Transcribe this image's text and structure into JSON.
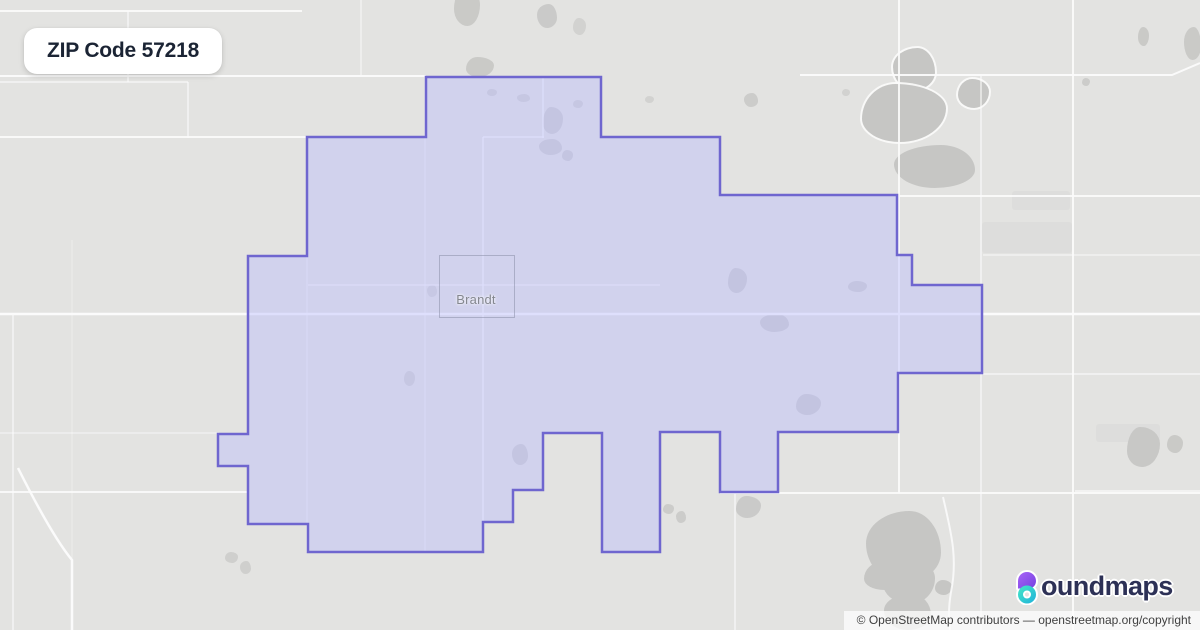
{
  "badge": {
    "label": "ZIP Code 57218"
  },
  "map": {
    "place_label": "Brandt",
    "place_box": {
      "x": 439,
      "y": 255,
      "w": 74,
      "h": 61
    },
    "colors": {
      "background": "#e3e3e1",
      "road": "#fbfbfb",
      "blob": "#c6c6c4",
      "patch": "#dbdbd9",
      "zip_fill": "rgba(186,188,252,0.45)",
      "zip_stroke": "#6f66cf",
      "place_label_color": "#84878f",
      "badge_text_color": "#1b2434"
    },
    "zip_polygon": [
      [
        426,
        77
      ],
      [
        601,
        77
      ],
      [
        601,
        137
      ],
      [
        720,
        137
      ],
      [
        720,
        195
      ],
      [
        897,
        195
      ],
      [
        897,
        255
      ],
      [
        912,
        255
      ],
      [
        912,
        285
      ],
      [
        982,
        285
      ],
      [
        982,
        373
      ],
      [
        898,
        373
      ],
      [
        898,
        432
      ],
      [
        778,
        432
      ],
      [
        778,
        492
      ],
      [
        720,
        492
      ],
      [
        720,
        432
      ],
      [
        660,
        432
      ],
      [
        660,
        552
      ],
      [
        602,
        552
      ],
      [
        602,
        433
      ],
      [
        543,
        433
      ],
      [
        543,
        490
      ],
      [
        513,
        490
      ],
      [
        513,
        522
      ],
      [
        483,
        522
      ],
      [
        483,
        552
      ],
      [
        308,
        552
      ],
      [
        308,
        524
      ],
      [
        248,
        524
      ],
      [
        248,
        466
      ],
      [
        218,
        466
      ],
      [
        218,
        434
      ],
      [
        248,
        434
      ],
      [
        248,
        256
      ],
      [
        307,
        256
      ],
      [
        307,
        137
      ],
      [
        426,
        137
      ]
    ],
    "roads": [
      {
        "d": "M0,11 H302",
        "w": 2,
        "o": 0.9
      },
      {
        "d": "M128,11 V82",
        "w": 1.5,
        "o": 0.75
      },
      {
        "d": "M0,82 H188",
        "w": 1.5,
        "o": 0.75
      },
      {
        "d": "M188,82 V138",
        "w": 1.5,
        "o": 0.75
      },
      {
        "d": "M0,76 H426",
        "w": 2,
        "o": 0.95
      },
      {
        "d": "M361,0 V76",
        "w": 1.5,
        "o": 0.6
      },
      {
        "d": "M0,137 H308",
        "w": 2,
        "o": 0.9
      },
      {
        "d": "M0,314 H1200",
        "w": 2.5,
        "o": 1
      },
      {
        "d": "M897,196 H1200",
        "w": 2,
        "o": 0.9
      },
      {
        "d": "M983,255 H1200",
        "w": 1.5,
        "o": 0.6
      },
      {
        "d": "M983,374 H1200",
        "w": 1.5,
        "o": 0.75
      },
      {
        "d": "M800,75 H1172 L1200,63",
        "w": 2,
        "o": 0.95
      },
      {
        "d": "M1073,0 V630",
        "w": 2,
        "o": 0.9
      },
      {
        "d": "M899,0 V493",
        "w": 2,
        "o": 0.9
      },
      {
        "d": "M981,75 V630",
        "w": 1.5,
        "o": 0.75
      },
      {
        "d": "M13,314 V630",
        "w": 1.5,
        "o": 0.75
      },
      {
        "d": "M72,240 V630",
        "w": 1,
        "o": 0.45
      },
      {
        "d": "M18,468 C38,508 58,543 72,560 V630",
        "w": 2.5,
        "o": 1
      },
      {
        "d": "M0,433 H219",
        "w": 1.5,
        "o": 0.55
      },
      {
        "d": "M0,492 H249",
        "w": 2,
        "o": 0.85
      },
      {
        "d": "M720,493 H1200",
        "w": 2,
        "o": 0.9
      },
      {
        "d": "M735,493 V630",
        "w": 1.5,
        "o": 0.75
      },
      {
        "d": "M943,497 C951,532 958,558 951,592 C948,610 949,620 950,630",
        "w": 2,
        "o": 0.85
      },
      {
        "d": "M543,76 V138",
        "w": 1.5,
        "o": 0.8
      },
      {
        "d": "M483,137 H544",
        "w": 1.5,
        "o": 0.8
      },
      {
        "d": "M483,137 V552",
        "w": 1.5,
        "o": 0.8
      },
      {
        "d": "M307,137 V552",
        "w": 1.2,
        "o": 0.55
      },
      {
        "d": "M425,76 V552",
        "w": 1.2,
        "o": 0.55
      },
      {
        "d": "M308,285 H660",
        "w": 1.5,
        "o": 0.7
      },
      {
        "d": "M1075,491 H1200",
        "w": 1.5,
        "o": 0.8
      }
    ],
    "blob_radius_presets": [
      "50% 50% 50% 50% / 50% 50% 50% 50%",
      "46% 54% 48% 52% / 55% 44% 56% 45%",
      "58% 42% 50% 50% / 45% 58% 42% 55%",
      "40% 60% 55% 45% / 60% 42% 58% 40%"
    ],
    "blobs": [
      [
        454,
        -12,
        26,
        38,
        1,
        0.9,
        0
      ],
      [
        537,
        4,
        20,
        24,
        2,
        0.85,
        0
      ],
      [
        466,
        57,
        28,
        20,
        3,
        0.9,
        0
      ],
      [
        573,
        18,
        13,
        17,
        1,
        0.6,
        0
      ],
      [
        893,
        48,
        42,
        42,
        2,
        1,
        1
      ],
      [
        862,
        84,
        84,
        58,
        3,
        1,
        1
      ],
      [
        958,
        79,
        31,
        29,
        1,
        1,
        1
      ],
      [
        894,
        145,
        81,
        43,
        2,
        1,
        0
      ],
      [
        1138,
        27,
        11,
        19,
        1,
        0.9,
        0
      ],
      [
        1184,
        27,
        17,
        33,
        2,
        0.9,
        0
      ],
      [
        1082,
        78,
        8,
        8,
        1,
        0.8,
        0
      ],
      [
        543,
        107,
        20,
        27,
        3,
        0.8,
        0
      ],
      [
        539,
        139,
        23,
        16,
        2,
        0.8,
        0
      ],
      [
        562,
        150,
        11,
        11,
        1,
        0.8,
        0
      ],
      [
        487,
        89,
        10,
        7,
        1,
        0.7,
        0
      ],
      [
        517,
        94,
        13,
        8,
        2,
        0.7,
        0
      ],
      [
        573,
        100,
        10,
        8,
        1,
        0.7,
        0
      ],
      [
        744,
        93,
        14,
        14,
        2,
        0.8,
        0
      ],
      [
        728,
        268,
        19,
        25,
        3,
        0.85,
        0
      ],
      [
        760,
        314,
        29,
        18,
        2,
        0.85,
        0
      ],
      [
        848,
        281,
        19,
        11,
        1,
        0.8,
        0
      ],
      [
        796,
        394,
        25,
        21,
        3,
        0.85,
        0
      ],
      [
        512,
        444,
        16,
        21,
        2,
        0.8,
        0
      ],
      [
        404,
        371,
        11,
        15,
        1,
        0.7,
        0
      ],
      [
        427,
        285,
        10,
        12,
        2,
        0.6,
        0
      ],
      [
        645,
        96,
        9,
        7,
        1,
        0.6,
        0
      ],
      [
        842,
        89,
        8,
        7,
        1,
        0.6,
        0
      ],
      [
        736,
        496,
        25,
        22,
        3,
        0.85,
        0
      ],
      [
        663,
        504,
        11,
        10,
        1,
        0.8,
        0
      ],
      [
        676,
        511,
        10,
        12,
        2,
        0.8,
        0
      ],
      [
        225,
        552,
        13,
        11,
        1,
        0.7,
        0
      ],
      [
        240,
        561,
        11,
        13,
        2,
        0.7,
        0
      ],
      [
        1127,
        427,
        33,
        40,
        3,
        0.95,
        0
      ],
      [
        1167,
        435,
        16,
        18,
        1,
        0.9,
        0
      ],
      [
        866,
        511,
        75,
        72,
        2,
        1,
        0
      ],
      [
        883,
        558,
        52,
        46,
        1,
        1,
        0
      ],
      [
        864,
        562,
        45,
        28,
        3,
        1,
        0
      ],
      [
        935,
        580,
        17,
        15,
        1,
        1,
        0
      ],
      [
        884,
        594,
        47,
        36,
        2,
        1,
        0
      ]
    ],
    "patches": [
      [
        982,
        222,
        90,
        31
      ],
      [
        1012,
        191,
        58,
        19
      ],
      [
        1096,
        424,
        64,
        18
      ]
    ]
  },
  "logo": {
    "brand": "boundmaps",
    "wordmark_text": "oundmaps",
    "text_color": "#2d3156",
    "icon_purple_light": "#a964f7",
    "icon_purple_dark": "#7440e0",
    "icon_teal_light": "#3fe0c8",
    "icon_teal_dark": "#25b9d8"
  },
  "attribution": {
    "text": "© OpenStreetMap contributors — openstreetmap.org/copyright"
  }
}
